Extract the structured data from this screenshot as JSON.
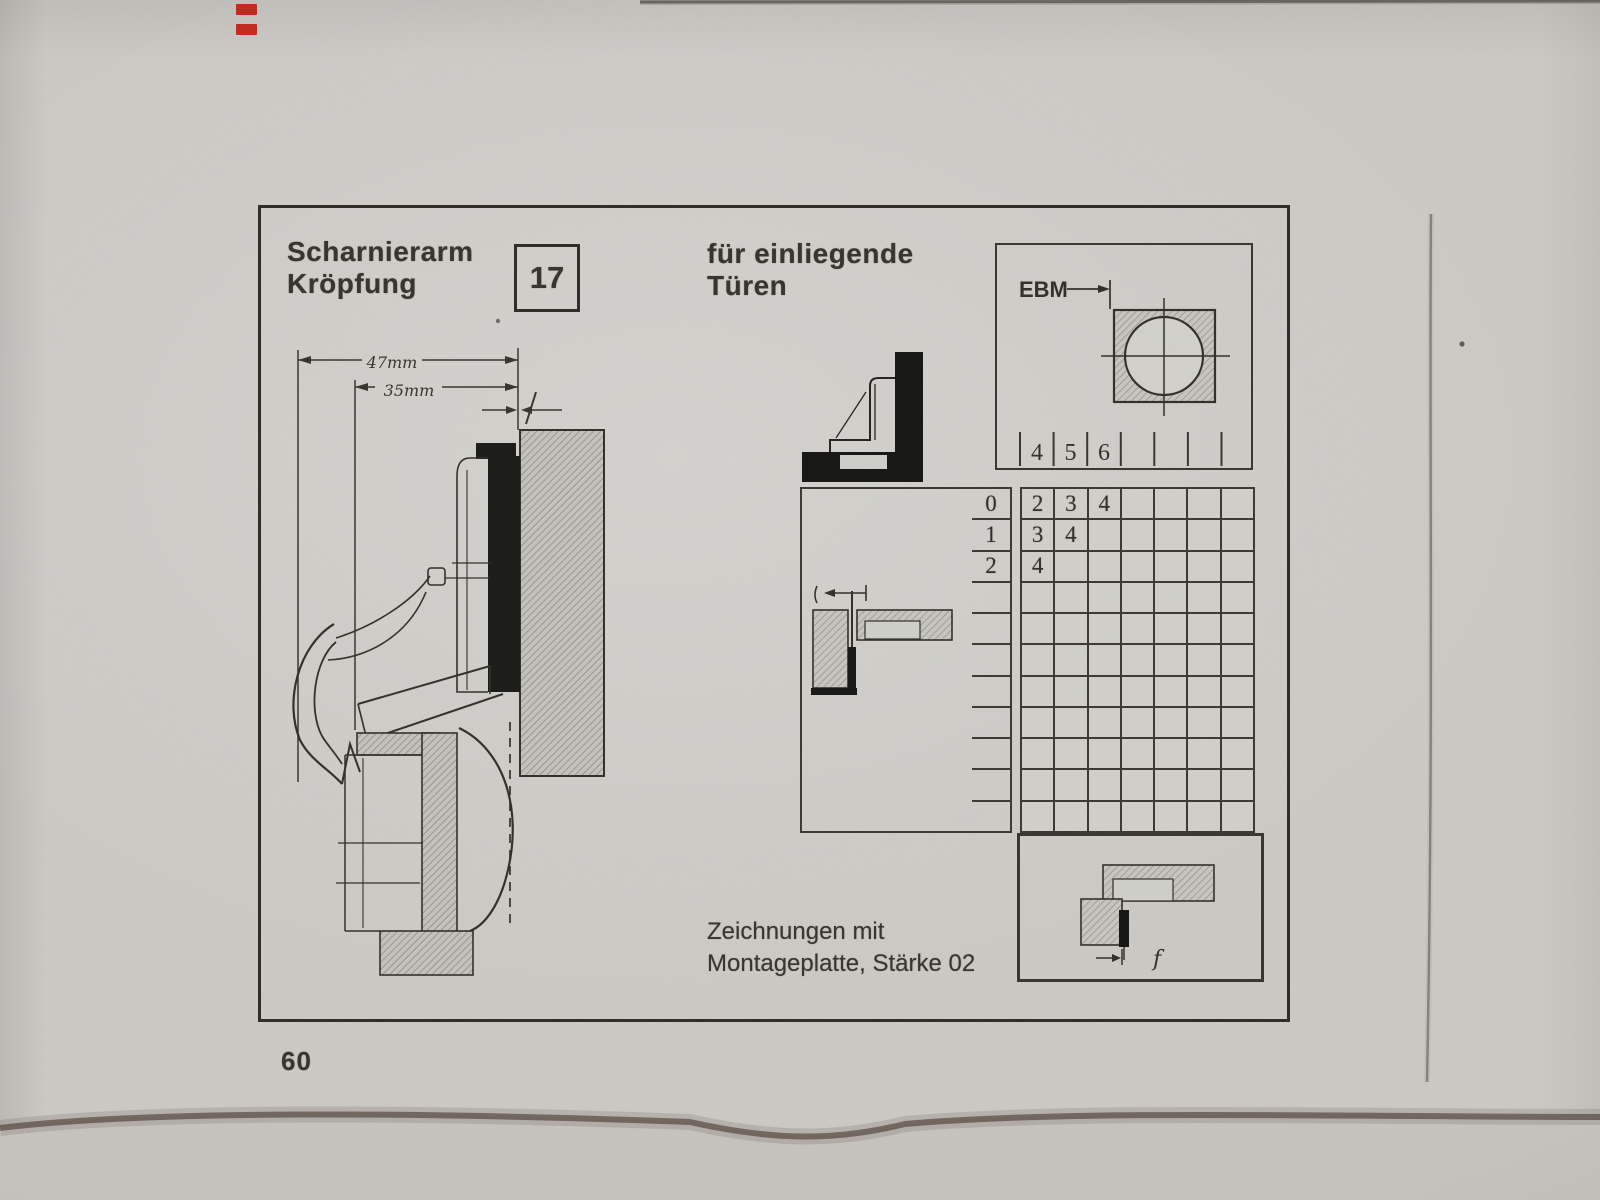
{
  "header": {
    "title_line1": "Scharnierarm",
    "title_line2": "Kröpfung",
    "hinge_size": "17",
    "subtitle_line1": "für einliegende",
    "subtitle_line2": "Türen"
  },
  "main_drawing": {
    "dim_outer": "47mm",
    "dim_inner": "35mm"
  },
  "drill_diagram": {
    "label": "EBM",
    "header_cells": [
      "4",
      "5",
      "6",
      "",
      "",
      "",
      ""
    ]
  },
  "table": {
    "row_labels": [
      "0",
      "1",
      "2",
      "",
      "",
      "",
      "",
      "",
      "",
      "",
      ""
    ],
    "cells": [
      [
        "2",
        "3",
        "4",
        "",
        "",
        "",
        ""
      ],
      [
        "3",
        "4",
        "",
        "",
        "",
        "",
        ""
      ],
      [
        "4",
        "",
        "",
        "",
        "",
        "",
        ""
      ],
      [
        "",
        "",
        "",
        "",
        "",
        "",
        ""
      ],
      [
        "",
        "",
        "",
        "",
        "",
        "",
        ""
      ],
      [
        "",
        "",
        "",
        "",
        "",
        "",
        ""
      ],
      [
        "",
        "",
        "",
        "",
        "",
        "",
        ""
      ],
      [
        "",
        "",
        "",
        "",
        "",
        "",
        ""
      ],
      [
        "",
        "",
        "",
        "",
        "",
        "",
        ""
      ],
      [
        "",
        "",
        "",
        "",
        "",
        "",
        ""
      ],
      [
        "",
        "",
        "",
        "",
        "",
        "",
        ""
      ]
    ]
  },
  "plan_view": {
    "gap_label": "f"
  },
  "footer": {
    "caption_line1": "Zeichnungen mit",
    "caption_line2": "Montageplatte, Stärke 02",
    "page_number": "60"
  },
  "colors": {
    "paper": "#cfcec9",
    "ink": "#34322a",
    "grid_line": "#39382f",
    "red_mark": "#c0281d",
    "edge_shadow": "#4a392b"
  }
}
